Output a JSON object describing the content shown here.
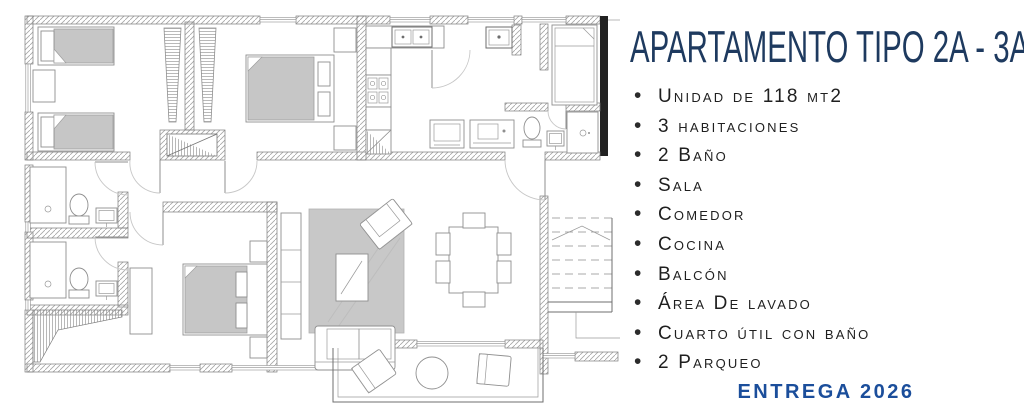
{
  "panel": {
    "title": "APARTAMENTO TIPO 2A - 3A",
    "features": [
      "Unidad de 118 mt2",
      "3 habitaciones",
      "2 Baño",
      "Sala",
      "Comedor",
      "Cocina",
      "Balcón",
      "Área De lavado",
      "Cuarto útil con baño",
      "2 Parqueo"
    ],
    "delivery": "Entrega 2026"
  },
  "colors": {
    "title": "#1e3a5f",
    "delivery": "#1b4e9b",
    "feature_text": "#1f1f1f",
    "plan_lines": "#8a8a8a",
    "furniture_gray": "#c6c6c6"
  },
  "floor_plan": {
    "elements": [
      "twin-bed",
      "twin-bed",
      "nightstand",
      "closet",
      "closet",
      "double-bed",
      "nightstand",
      "nightstand",
      "kitchen-sink",
      "stove",
      "refrigerator",
      "laundry-sink",
      "washer",
      "dryer",
      "single-bed",
      "toilet",
      "hand-sink",
      "shower",
      "shower",
      "toilet",
      "hand-sink",
      "shower",
      "toilet",
      "hand-sink",
      "master-bed",
      "dresser",
      "wardrobe",
      "tv-console",
      "rug",
      "coffee-table",
      "armchair",
      "sofa",
      "dining-table",
      "dining-chair",
      "balcony-lounge-chair",
      "balcony-table",
      "balcony-chair",
      "staircase"
    ]
  }
}
